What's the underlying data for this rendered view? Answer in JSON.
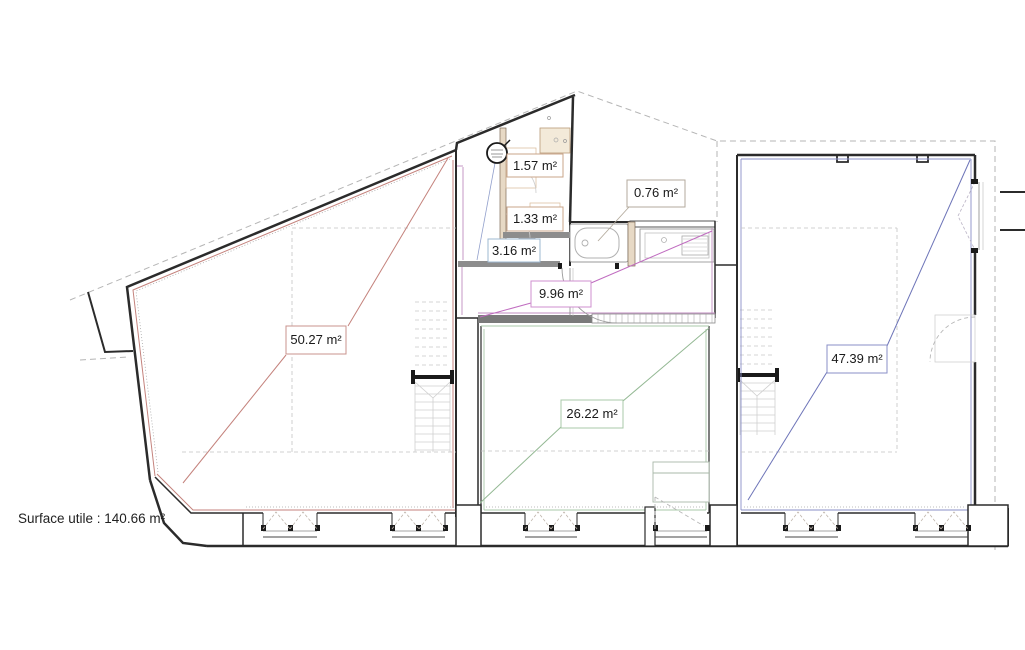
{
  "plan": {
    "surface_note": "Surface utile : 140.66 m²",
    "total_area": 140.66,
    "unit": "m²",
    "rooms": [
      {
        "name": "shower-room",
        "label": "1.57 m²",
        "area": 1.57,
        "accent": "#c9a489"
      },
      {
        "name": "wc-room",
        "label": "1.33 m²",
        "area": 1.33,
        "accent": "#c9a489"
      },
      {
        "name": "bath-entry",
        "label": "3.16 m²",
        "area": 3.16,
        "accent": "#9db8d2"
      },
      {
        "name": "bathtub-niche",
        "label": "0.76 m²",
        "area": 0.76,
        "accent": "#b3aa9c"
      },
      {
        "name": "hallway",
        "label": "9.96 m²",
        "area": 9.96,
        "accent": "#cf8fcf"
      },
      {
        "name": "room-left",
        "label": "50.27 m²",
        "area": 50.27,
        "accent": "#c9938d"
      },
      {
        "name": "room-middle",
        "label": "26.22 m²",
        "area": 26.22,
        "accent": "#a8c8a8"
      },
      {
        "name": "room-right",
        "label": "47.39 m²",
        "area": 47.39,
        "accent": "#8a8fc7"
      }
    ],
    "icons": {
      "water_heater": "circle-with-label",
      "steel_beam": "i-beam-section",
      "door_swing": "quarter-arc",
      "window_opening": "dashed-triangle"
    },
    "colors": {
      "wall": "#2b2b2b",
      "property_dashed": "#b5b5b5",
      "left_room_line": "#c4827c",
      "middle_room_line": "#93b893",
      "right_room_line": "#6d74b8",
      "hallway_line": "#c06cc0"
    }
  }
}
